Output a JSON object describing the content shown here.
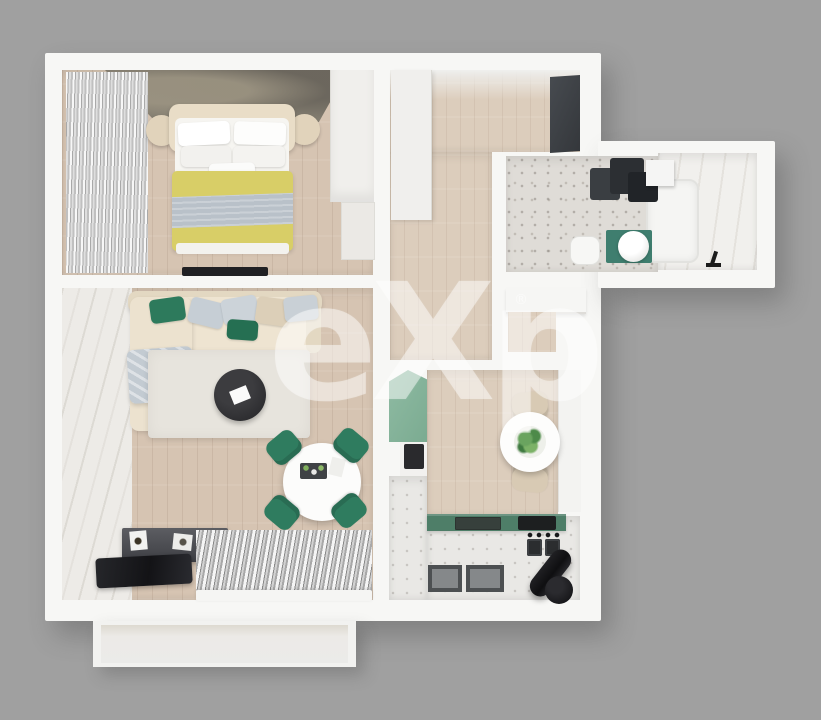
{
  "scene": {
    "description": "Top-down 3D render of a one-bedroom apartment floor plan on a grey background",
    "background_color": "#a0a0a0",
    "wall_color": "#f7f7f5"
  },
  "watermark": {
    "text": "eXp",
    "registered_mark": "®"
  },
  "palette": {
    "accent_green": "#2f7c5f",
    "sage_cabinet": "#84b29a",
    "countertop_green": "#4e7e68",
    "teal_mat": "#3f7e6f",
    "blanket_yellow": "#d8ce67",
    "blanket_grey_band": "#b9c1c9",
    "wood_floor": "#d6c4b2",
    "terrazzo_floor": "#dfdcd7",
    "marble_floor": "#edebe7",
    "dark_furniture": "#2c2f33",
    "sofa_beige": "#ece2cf"
  },
  "rooms": [
    {
      "name": "bedroom",
      "furniture": [
        "double-bed",
        "yellow-blanket",
        "nightstand-left",
        "nightstand-right",
        "wardrobe",
        "dresser",
        "tv",
        "window-curtains",
        "dark-accent-wall"
      ]
    },
    {
      "name": "hallway",
      "furniture": [
        "white-wardrobe",
        "dark-cabinet"
      ]
    },
    {
      "name": "bathroom",
      "furniture": [
        "bathtub",
        "washer-dryer-stack",
        "sink-box",
        "toilet",
        "teal-mat",
        "round-basin",
        "black-faucet"
      ]
    },
    {
      "name": "living-room",
      "furniture": [
        "corner-sofa",
        "throw-blanket",
        "area-rug",
        "round-coffee-table",
        "round-dining-table",
        "four-green-chairs",
        "sideboard",
        "picture-frames",
        "tv-glass-panel",
        "striped-window-curtain"
      ]
    },
    {
      "name": "kitchen",
      "furniture": [
        "sage-tall-cabinet",
        "built-in-oven",
        "round-table-with-plant",
        "two-beige-chairs",
        "green-countertop",
        "sink",
        "cooktop",
        "stove",
        "floor-mats",
        "black-cylinder-heater",
        "white-dresser"
      ]
    },
    {
      "name": "balcony",
      "furniture": []
    }
  ]
}
